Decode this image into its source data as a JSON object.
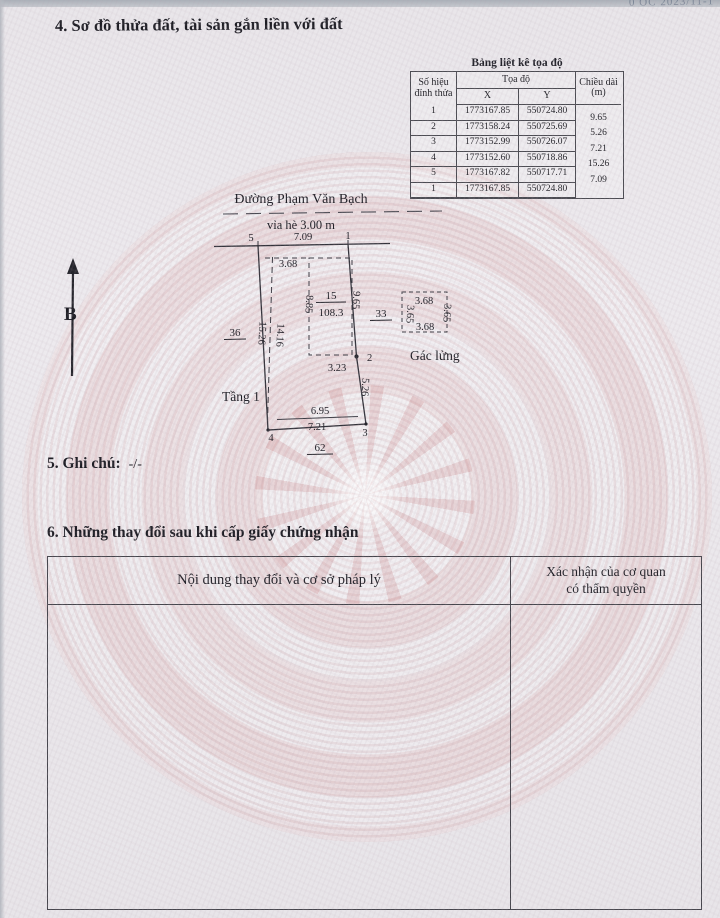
{
  "watermark": "0 OC 2023/11-1",
  "section4": {
    "title": "4. Sơ đồ thửa đất, tài sản gắn liền với đất"
  },
  "coord_table": {
    "title": "Bảng liệt kê tọa độ",
    "col_vertex_line1": "Số hiệu",
    "col_vertex_line2": "đỉnh thửa",
    "col_coords": "Tọa độ",
    "col_x": "X",
    "col_y": "Y",
    "col_length_line1": "Chiều dài",
    "col_length_line2": "(m)",
    "rows": [
      {
        "id": "1",
        "x": "1773167.85",
        "y": "550724.80"
      },
      {
        "id": "2",
        "x": "1773158.24",
        "y": "550725.69"
      },
      {
        "id": "3",
        "x": "1773152.99",
        "y": "550726.07"
      },
      {
        "id": "4",
        "x": "1773152.60",
        "y": "550718.86"
      },
      {
        "id": "5",
        "x": "1773167.82",
        "y": "550717.71"
      },
      {
        "id": "1",
        "x": "1773167.85",
        "y": "550724.80"
      }
    ],
    "lengths": [
      "9.65",
      "5.26",
      "7.21",
      "15.26",
      "7.09"
    ]
  },
  "compass": {
    "label": "B"
  },
  "diagram": {
    "street_name": "Đường Phạm Văn Bạch",
    "sidewalk": "vỉa hè 3.00 m",
    "vertices": {
      "v1": "1",
      "v2": "2",
      "v3": "3",
      "v4": "4",
      "v5": "5"
    },
    "dims": {
      "top": "7.09",
      "right_upper": "9.65",
      "right_lower": "5.26",
      "bottom_outer": "7.21",
      "bottom_inner": "6.95",
      "left_outer": "15.26",
      "left_inner": "14.16",
      "building_top": "3.68",
      "building_left": "8.85",
      "building_bottom": "3.23"
    },
    "parcel_number": "15",
    "parcel_area": "108.3",
    "neighbor_left": "36",
    "neighbor_right": "33",
    "neighbor_bottom": "62",
    "floor1_label": "Tầng 1",
    "mezzanine_label": "Gác lửng",
    "mezzanine_dims": {
      "top": "3.68",
      "left": "3.65",
      "right": "3.65",
      "bottom": "3.68"
    }
  },
  "section5": {
    "label": "5. Ghi chú:",
    "value": "-/-"
  },
  "section6": {
    "title": "6. Những thay đổi sau khi cấp giấy chứng nhận",
    "col1": "Nội dung thay đổi và cơ sở pháp lý",
    "col2_line1": "Xác nhận của cơ quan",
    "col2_line2": "có thẩm quyền"
  }
}
